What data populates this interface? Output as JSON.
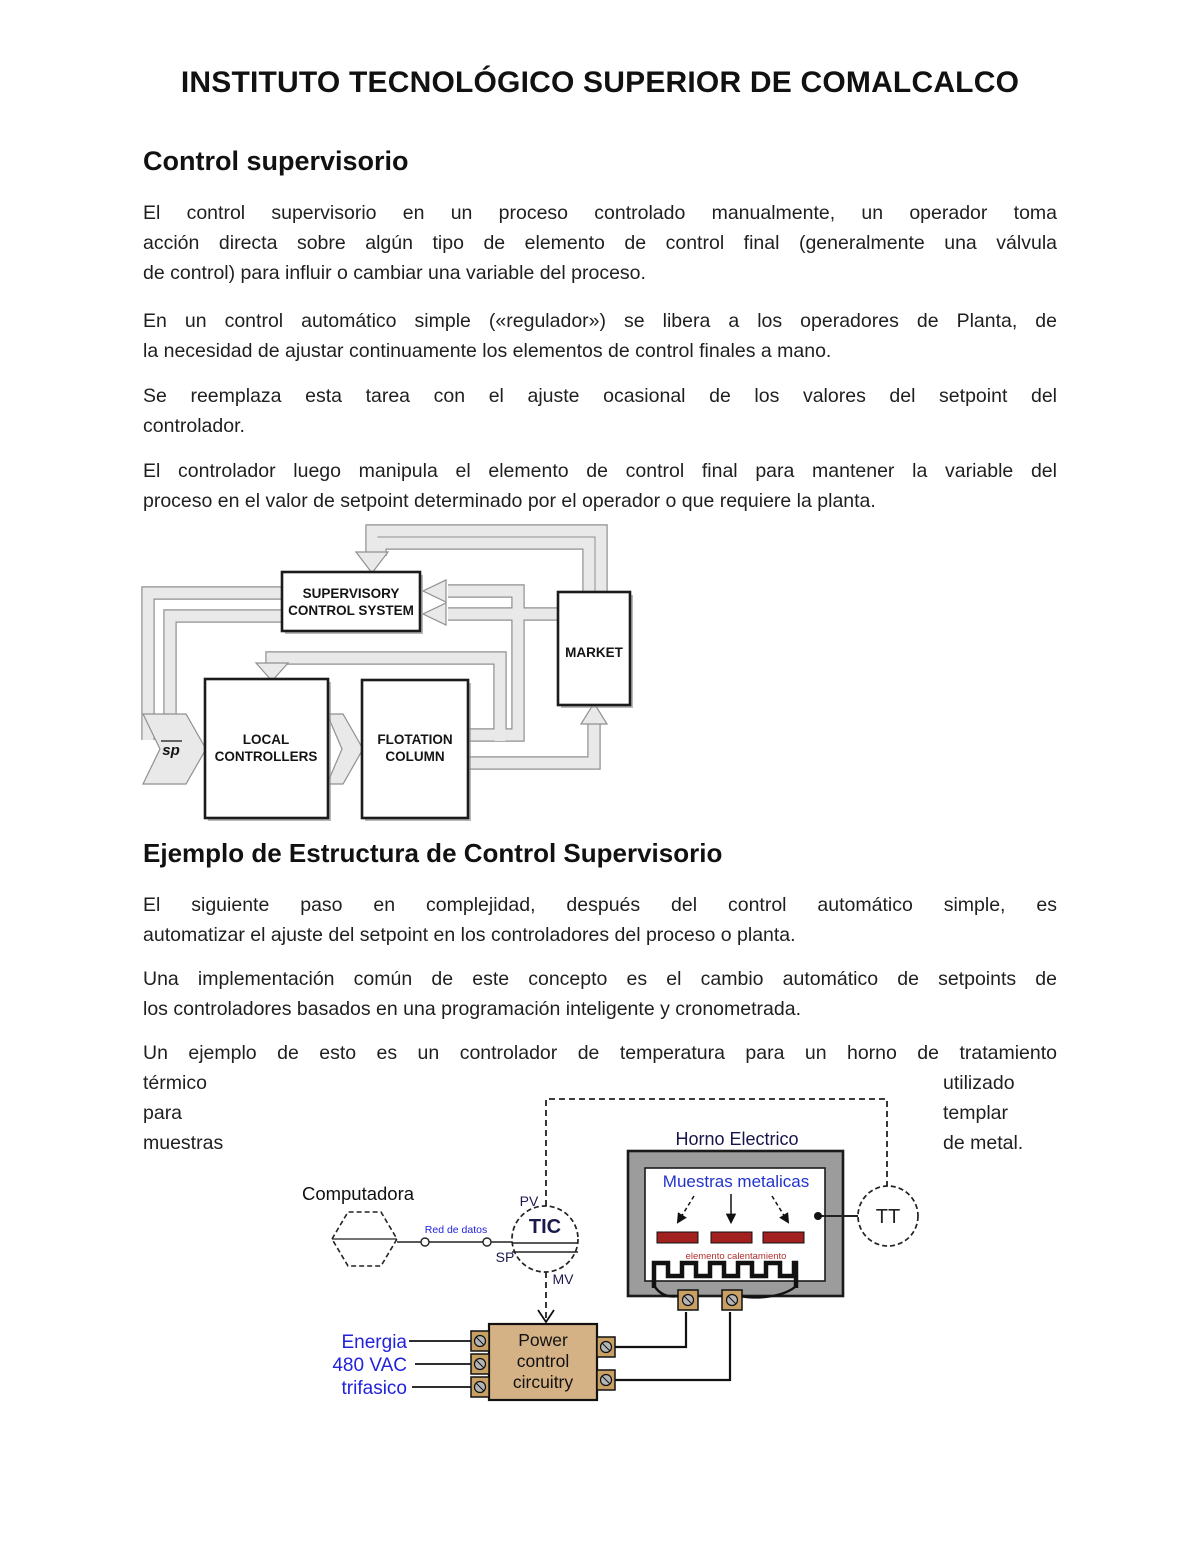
{
  "document": {
    "title": "INSTITUTO TECNOLÓGICO SUPERIOR DE COMALCALCO",
    "section1": {
      "heading": "Control supervisorio",
      "p1": [
        "El control supervisorio en un proceso controlado manualmente, un operador toma",
        "acción directa sobre algún tipo de elemento de control final (generalmente una válvula",
        "de control) para influir o cambiar una variable del proceso."
      ],
      "p2": [
        "En un control automático simple («regulador») se libera a los operadores de Planta, de",
        "la necesidad de ajustar continuamente los elementos de control finales a mano."
      ],
      "p3": [
        "Se reemplaza esta tarea con el ajuste ocasional de los valores del setpoint del",
        "controlador."
      ],
      "p4": [
        "El controlador luego manipula el elemento de control final para mantener la variable del",
        "proceso en el valor de setpoint determinado por el operador o que requiere la planta."
      ]
    },
    "section2": {
      "heading": "Ejemplo de Estructura de Control Supervisorio",
      "p5": [
        "El siguiente paso en complejidad, después del control automático simple, es",
        "automatizar el ajuste del setpoint en los controladores del proceso o planta."
      ],
      "p6": [
        "Una implementación común de este concepto es el cambio automático de setpoints de",
        "los controladores basados en una programación inteligente y cronometrada."
      ],
      "p7_line1": "Un ejemplo de esto es un controlador de temperatura para un horno de tratamiento",
      "p7_left": [
        "térmico",
        "para",
        "muestras"
      ],
      "p7_right": [
        "utilizado",
        "templar",
        "de metal."
      ]
    }
  },
  "diagram_supervisory": {
    "supervisory_box": [
      "SUPERVISORY",
      "CONTROL SYSTEM"
    ],
    "market_box": "MARKET",
    "local_controllers_box": [
      "LOCAL",
      "CONTROLLERS"
    ],
    "flotation_column_box": [
      "FLOTATION",
      "COLUMN"
    ],
    "setpoint_label": "sp"
  },
  "diagram_furnace": {
    "computer_label": "Computadora",
    "network_label": "Red de datos",
    "controller_tag": "TIC",
    "pv_label": "PV",
    "sp_label": "SP",
    "mv_label": "MV",
    "furnace_title": "Horno Electrico",
    "samples_label": "Muestras metalicas",
    "heater_label": "elemento calentamiento",
    "transmitter_tag": "TT",
    "power_box": [
      "Power",
      "control",
      "circuitry"
    ],
    "energy_labels": [
      "Energia",
      "480 VAC",
      "trifasico"
    ],
    "colors": {
      "accent_blue": "#2222dd",
      "label_navy": "#1a1a4e",
      "sample_red": "#a32020",
      "heater_label_red": "#b03030",
      "power_tan": "#d5b285",
      "terminal_tan": "#c9a063",
      "oven_gray": "#9c9c9c",
      "band_gray": "#e9e9e9"
    }
  }
}
